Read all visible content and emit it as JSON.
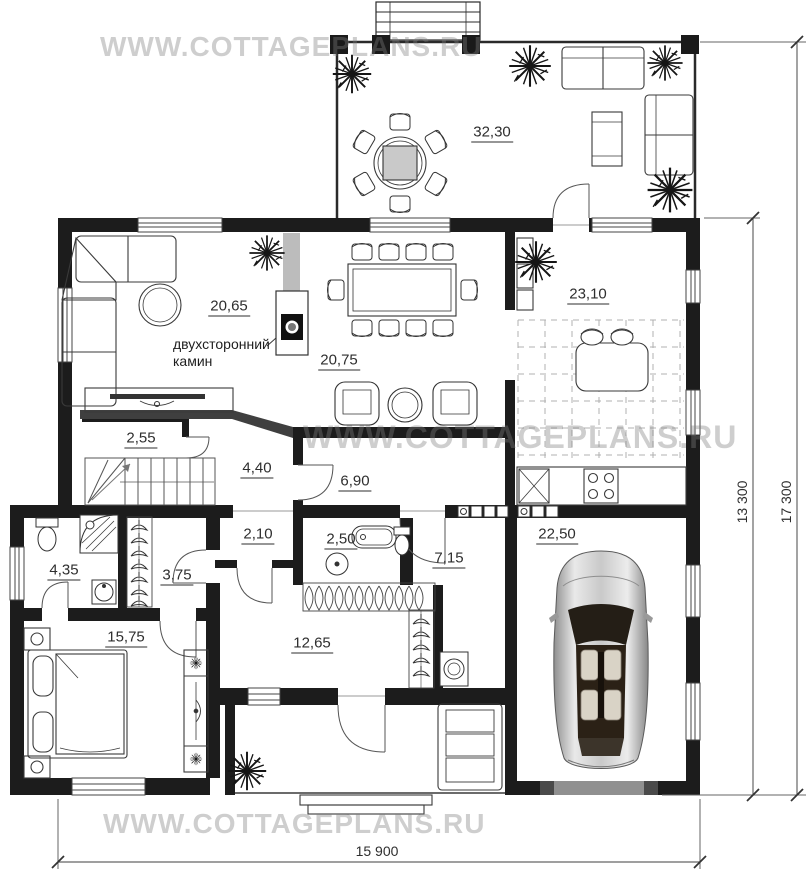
{
  "watermark": {
    "text": "WWW.COTTAGEPLANS.RU"
  },
  "plan": {
    "fireplace_note": "двухсторонний\nкамин",
    "rooms": [
      {
        "name": "terrace",
        "area": "32,30"
      },
      {
        "name": "living-room",
        "area": "20,65"
      },
      {
        "name": "dining-room",
        "area": "20,75"
      },
      {
        "name": "kitchen",
        "area": "23,10"
      },
      {
        "name": "pantry",
        "area": "2,55"
      },
      {
        "name": "hall",
        "area": "4,40"
      },
      {
        "name": "corridor",
        "area": "6,90"
      },
      {
        "name": "wc",
        "area": "2,10"
      },
      {
        "name": "bathroom",
        "area": "2,50"
      },
      {
        "name": "utility-room",
        "area": "7,15"
      },
      {
        "name": "garage",
        "area": "22,50"
      },
      {
        "name": "master-bathroom",
        "area": "4,35"
      },
      {
        "name": "wardrobe",
        "area": "3,75"
      },
      {
        "name": "bedroom",
        "area": "15,75"
      },
      {
        "name": "entry-hall",
        "area": "12,65"
      }
    ],
    "dimensions": {
      "total_width": "15 900",
      "main_depth": "13 300",
      "total_depth": "17 300"
    }
  }
}
